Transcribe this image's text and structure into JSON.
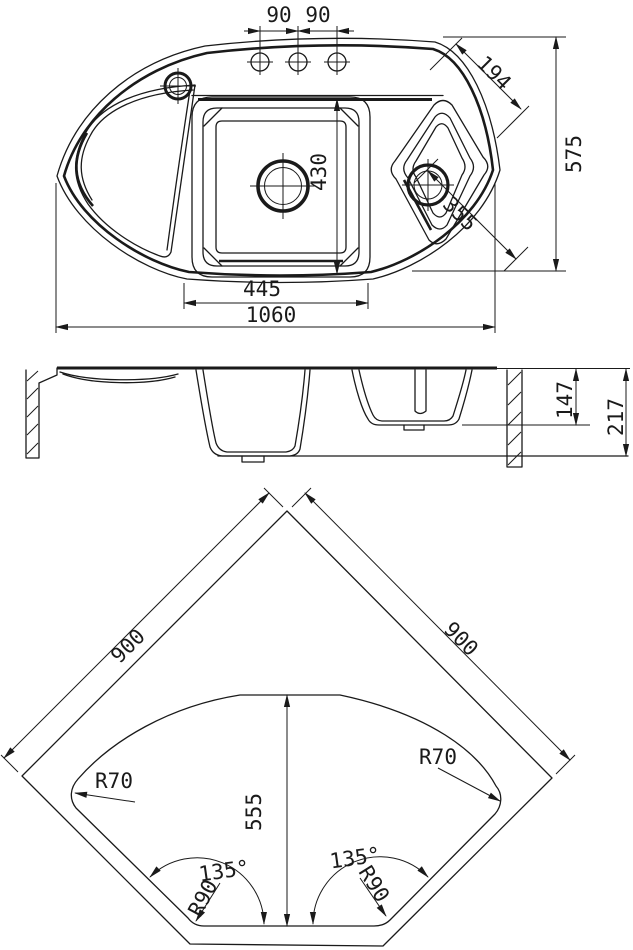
{
  "document": {
    "type": "technical-drawing",
    "subject": "corner kitchen sink with one and a half bowls",
    "colors": {
      "line": "#1a1a1a",
      "background": "#ffffff"
    }
  },
  "top_view": {
    "dims": {
      "faucet_pitch_left": "90",
      "faucet_pitch_right": "90",
      "small_bowl_width": "194",
      "overall_depth": "575",
      "main_bowl_length": "430",
      "small_bowl_diagonal": "355",
      "main_bowl_width": "445",
      "overall_width": "1060"
    }
  },
  "section_view": {
    "dims": {
      "small_bowl_depth": "147",
      "overall_height": "217"
    }
  },
  "cutout_view": {
    "dims": {
      "side_left": "900",
      "side_right": "900",
      "cutout_depth": "555",
      "radius_left": "R70",
      "radius_right": "R70",
      "angle_left": "135°",
      "angle_right": "135°",
      "corner_radius_left": "R90",
      "corner_radius_right": "R90"
    }
  }
}
